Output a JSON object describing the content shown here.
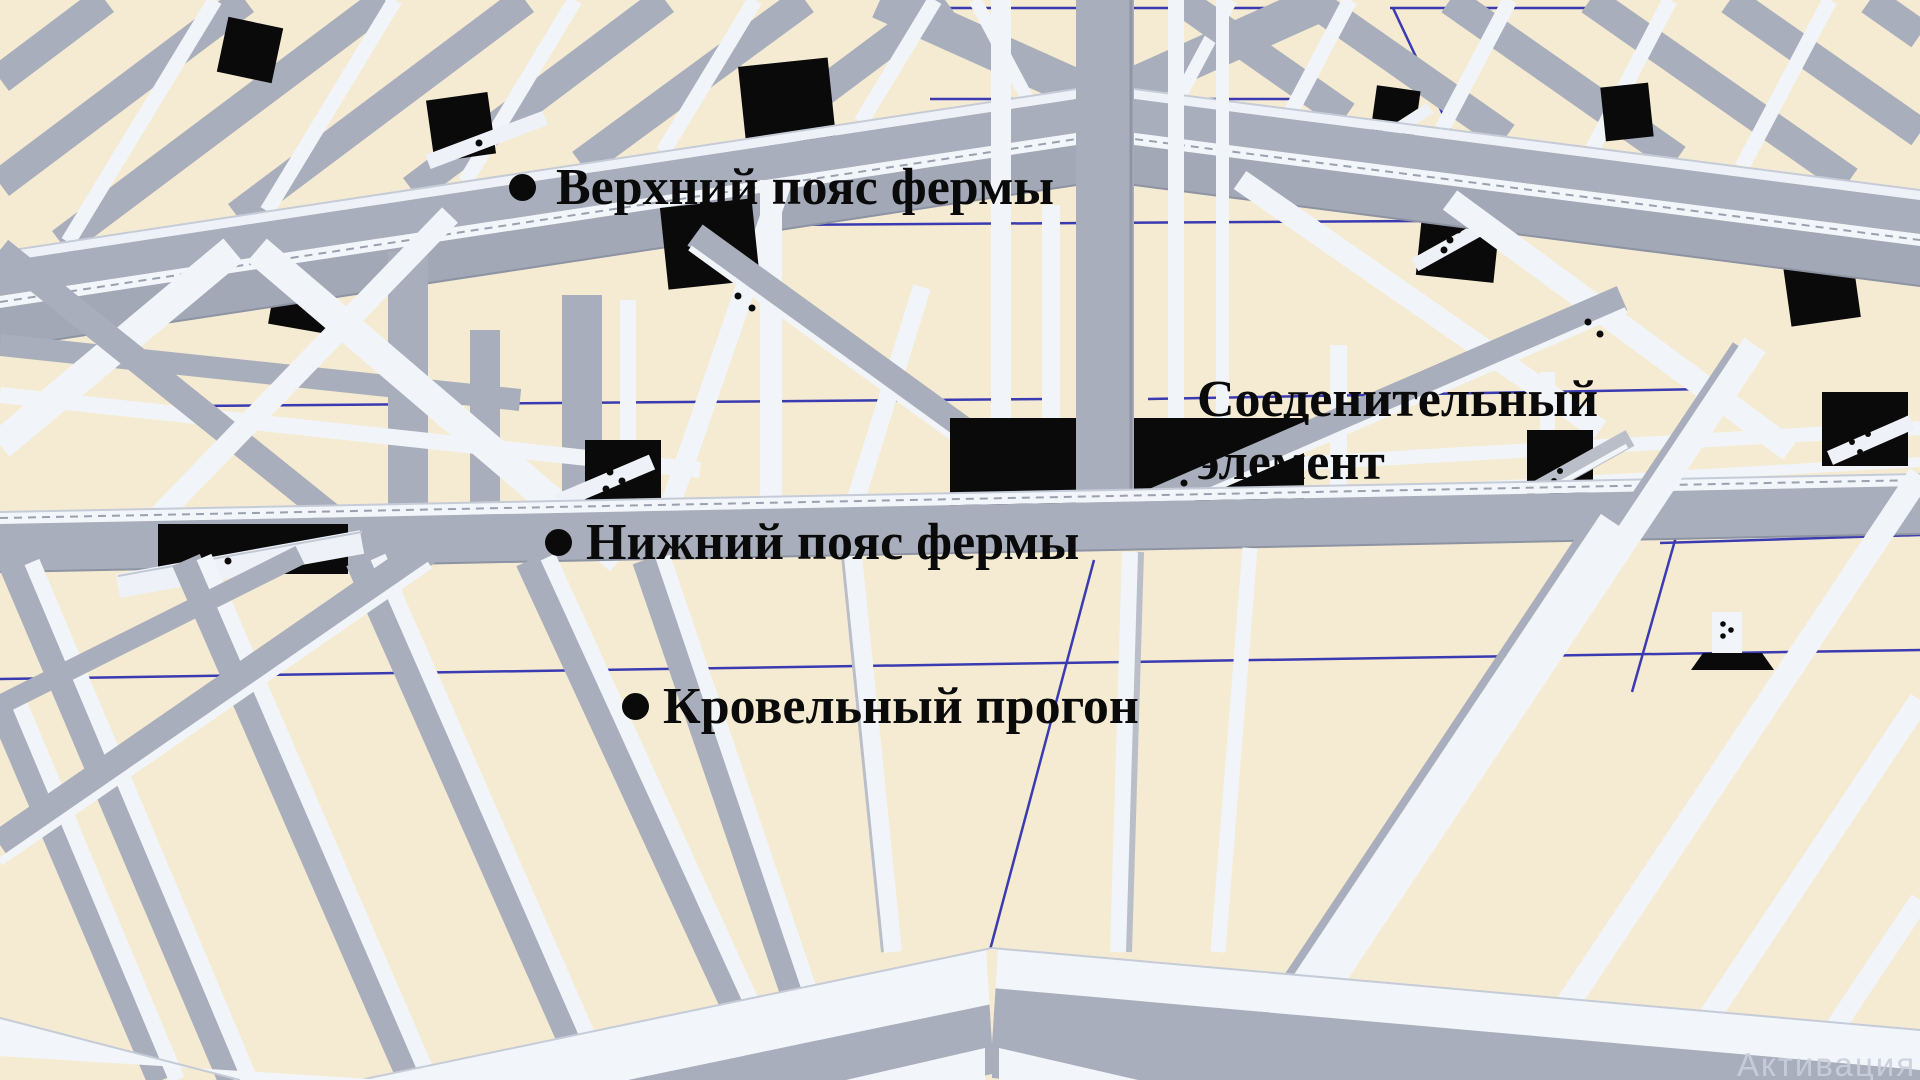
{
  "scene": {
    "background_color": "#f5ebd2",
    "grid_color": "#2b2bb0",
    "beam_gray_color": "#a9aebc",
    "beam_white_color": "#f1f5fa",
    "plate_color": "#0a0a0a",
    "label_text_color": "#0a0a0a"
  },
  "annotations": {
    "items": [
      {
        "id": "upper-chord",
        "lines": [
          "Верхний пояс фермы"
        ]
      },
      {
        "id": "connector",
        "lines": [
          "Соеденительный",
          "элемент"
        ]
      },
      {
        "id": "lower-chord",
        "lines": [
          "Нижний пояс фермы"
        ]
      },
      {
        "id": "roof-purlin",
        "lines": [
          "Кровельный прогон"
        ]
      }
    ]
  },
  "watermark": {
    "text": "Активация W"
  }
}
